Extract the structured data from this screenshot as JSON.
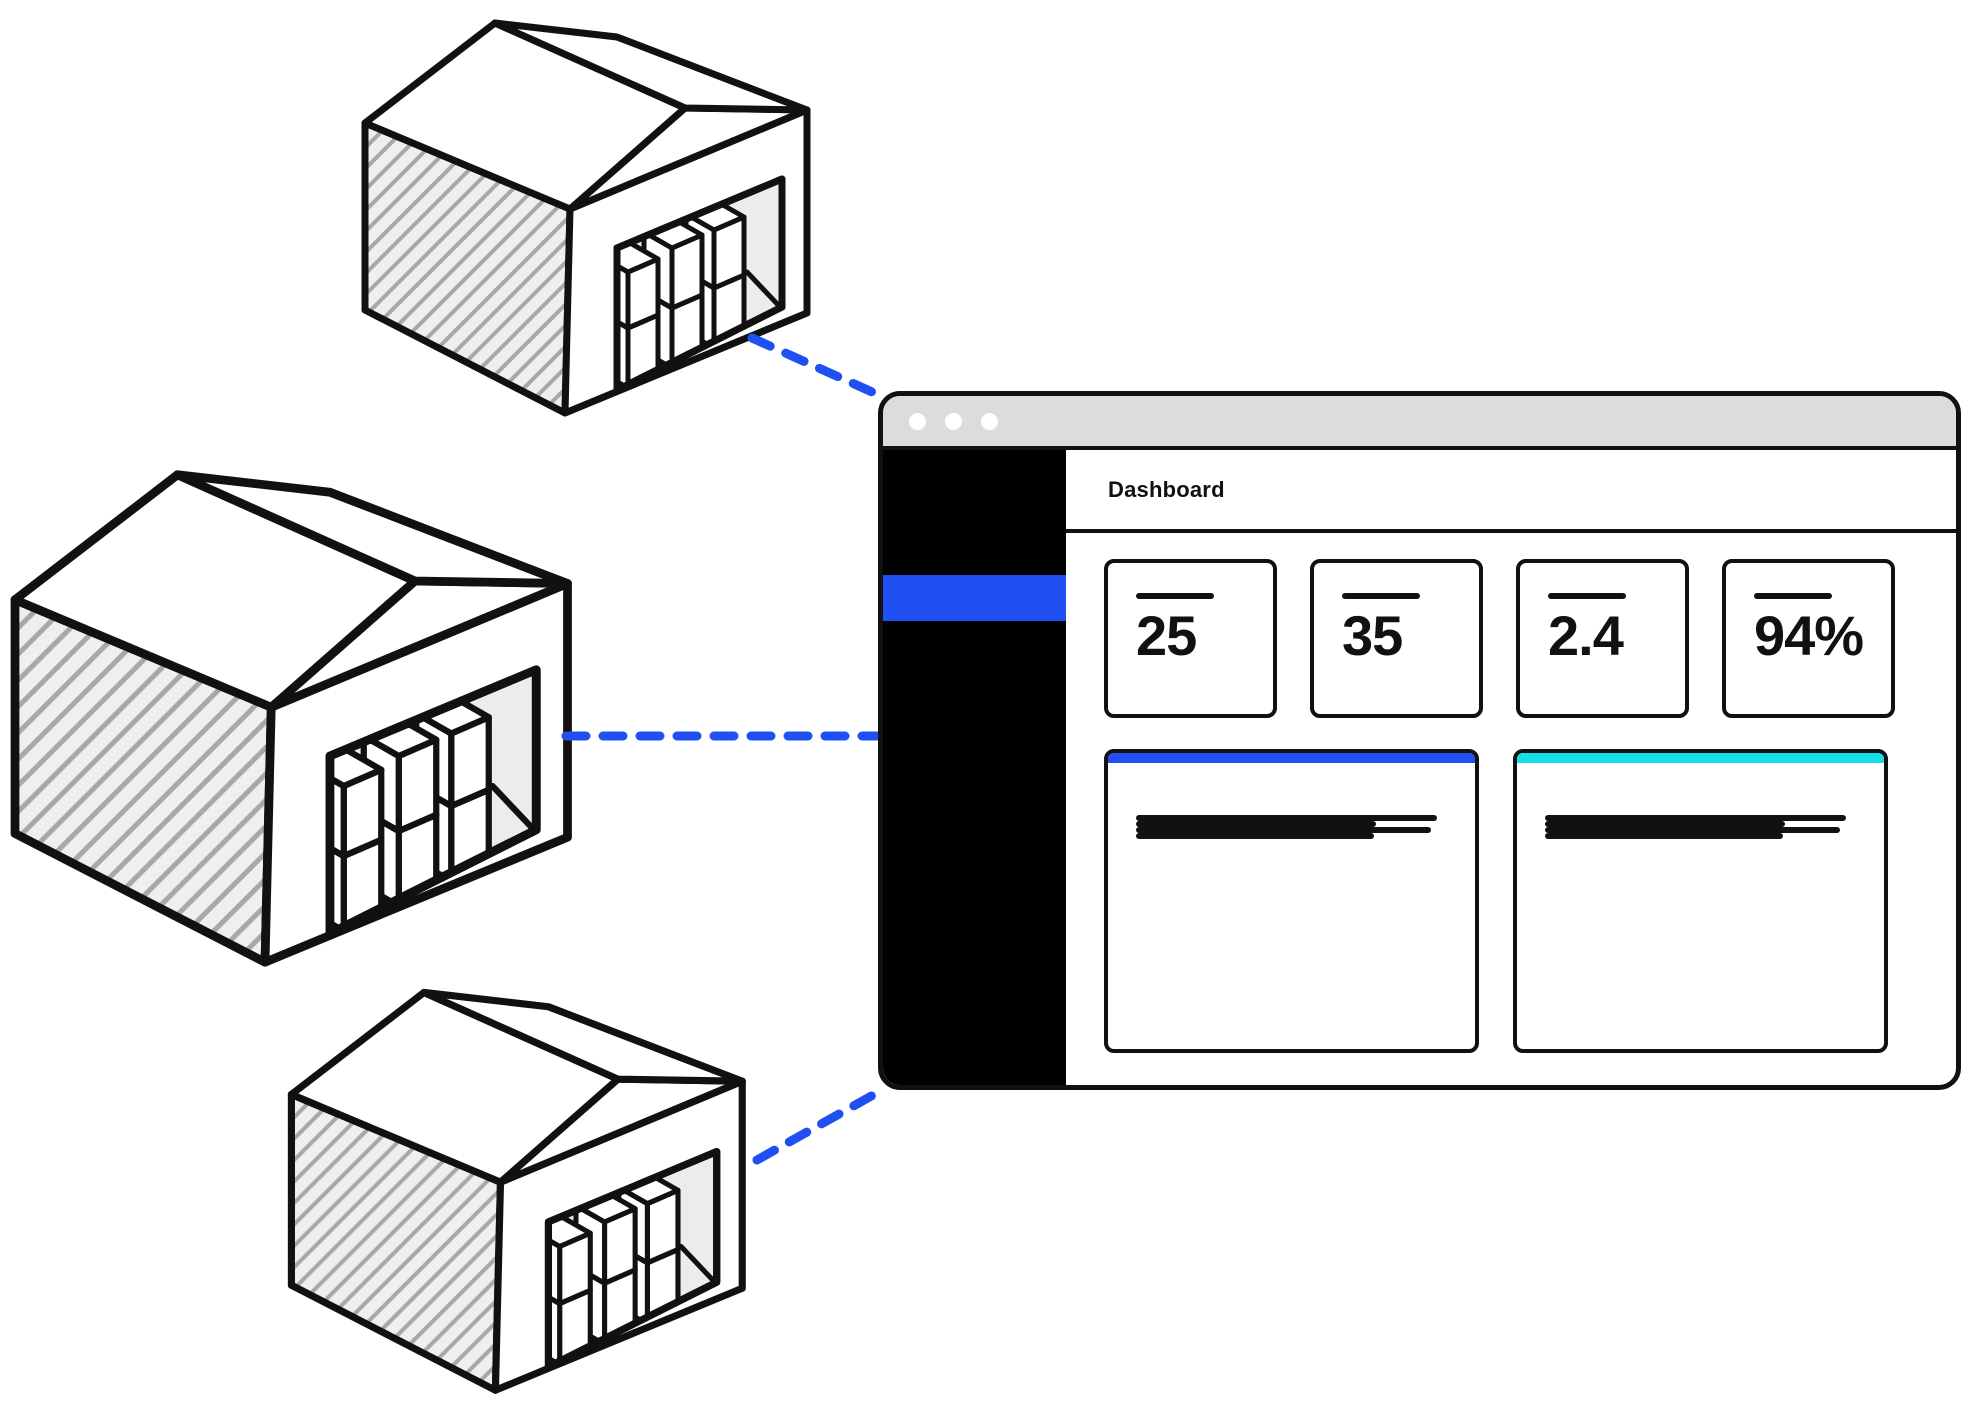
{
  "canvas": {
    "width": 1984,
    "height": 1415
  },
  "colors": {
    "accent_blue": "#2150f2",
    "accent_cyan": "#16dfe8",
    "titlebar_gray": "#dcdcdc",
    "outline_black": "#111111",
    "wall_fill": "#efefef",
    "hatch_line": "#a8a8a8",
    "interior_gray": "#ececec"
  },
  "illustration": {
    "warehouses": [
      {
        "id": "top",
        "description": "isometric warehouse with stacked boxes"
      },
      {
        "id": "middle",
        "description": "isometric warehouse with stacked boxes"
      },
      {
        "id": "bottom",
        "description": "isometric warehouse with stacked boxes"
      }
    ],
    "connector_count": 3
  },
  "browser_window": {
    "titlebar": {
      "control_dot_count": 3
    },
    "sidebar": {
      "active_item_highlighted": true
    },
    "page_title": "Dashboard",
    "stat_cards": [
      {
        "value": "25"
      },
      {
        "value": "35"
      },
      {
        "value": "2.4"
      },
      {
        "value": "94%"
      }
    ],
    "panels": [
      {
        "accent_color": "#2150f2",
        "placeholder_line_count": 4
      },
      {
        "accent_color": "#16dfe8",
        "placeholder_line_count": 4
      }
    ]
  }
}
